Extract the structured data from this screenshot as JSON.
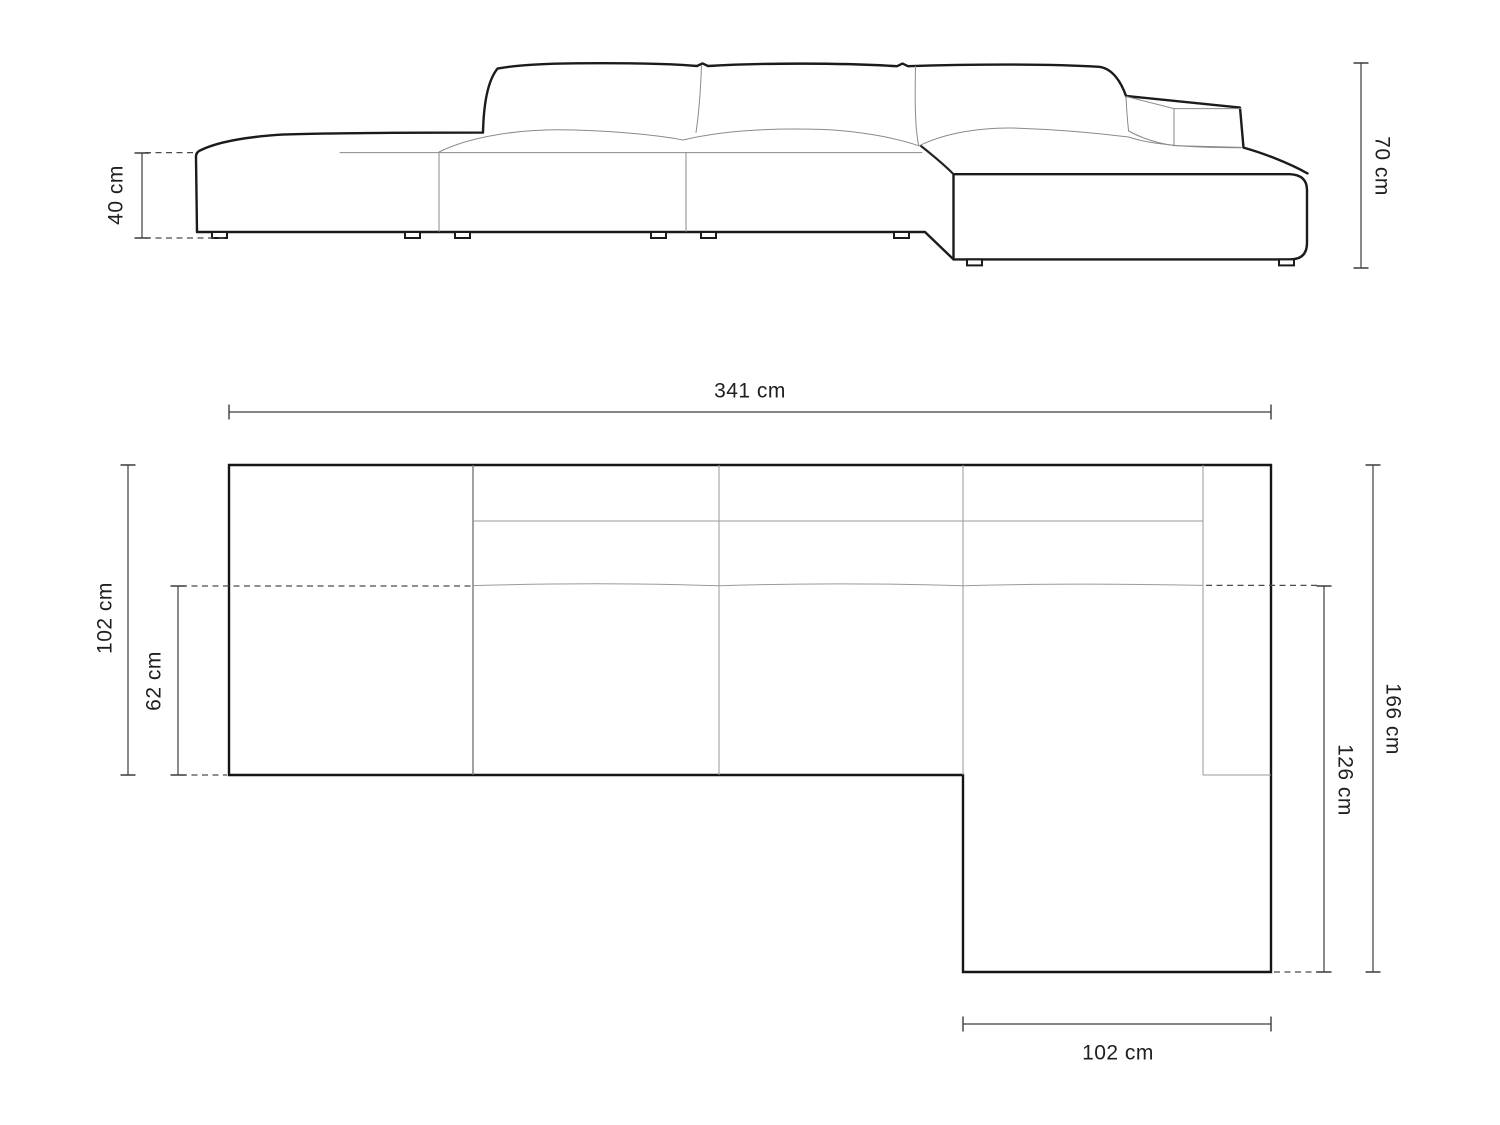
{
  "side_view": {
    "seat_height_label": "40 cm",
    "overall_height_label": "70 cm"
  },
  "plan_view": {
    "overall_width_label": "341 cm",
    "overall_depth_label": "102 cm",
    "seat_depth_label": "62 cm",
    "right_total_depth_label": "166 cm",
    "chaise_length_label": "126 cm",
    "chaise_width_label": "102 cm"
  },
  "colors": {
    "outline": "#1b1b1b",
    "thin_detail": "#8a8a8a",
    "dimension": "#3c3c3c",
    "text": "#1f1f1f",
    "background": "#ffffff"
  }
}
